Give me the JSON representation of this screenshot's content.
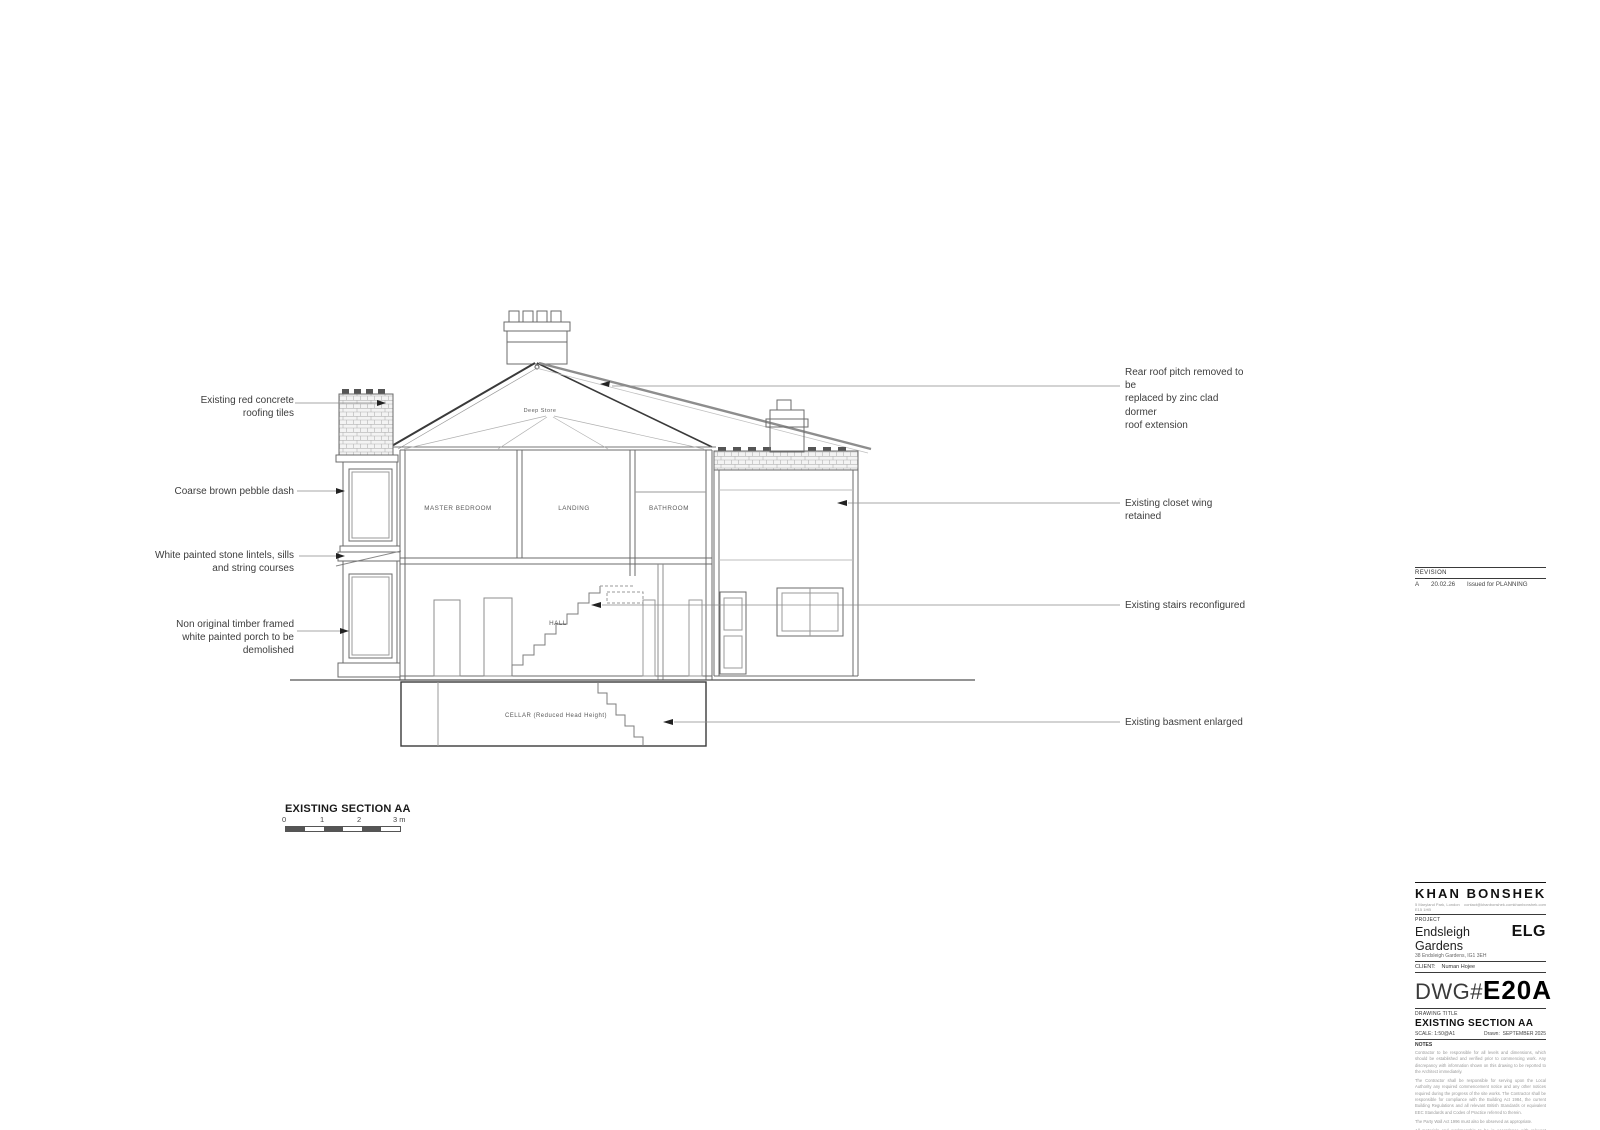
{
  "drawing": {
    "caption": "EXISTING SECTION AA",
    "rooms": {
      "deep_store": "Deep Store",
      "master_bedroom": "MASTER BEDROOM",
      "landing": "LANDING",
      "bathroom": "BATHROOM",
      "hall": "HALL",
      "cellar": "CELLAR (Reduced Head Height)"
    },
    "scale_bar": {
      "ticks": [
        "0",
        "1",
        "2",
        "3 m"
      ]
    }
  },
  "annotations": {
    "left": [
      {
        "label": "Existing red concrete\nroofing tiles"
      },
      {
        "label": "Coarse brown pebble dash"
      },
      {
        "label": "White painted stone lintels, sills\nand string courses"
      },
      {
        "label": "Non original timber framed\nwhite painted porch to be\ndemolished"
      }
    ],
    "right": [
      {
        "label": "Rear roof pitch removed to be\nreplaced by zinc clad dormer\nroof extension"
      },
      {
        "label": "Existing closet wing retained"
      },
      {
        "label": "Existing stairs reconfigured"
      },
      {
        "label": "Existing basment enlarged"
      }
    ]
  },
  "revision": {
    "header": "REVISION",
    "rows": [
      {
        "rev": "A",
        "date": "20.02.26",
        "desc": "Issued for PLANNING"
      }
    ]
  },
  "title_block": {
    "firm_name": "KHAN BONSHEK",
    "firm_address": "5 Maryland Park, London E15 1HB",
    "firm_email": "contact@khanbonshek.com",
    "firm_web": "khanbonshek.com",
    "project_label": "PROJECT",
    "project_name": "Endsleigh Gardens",
    "project_address": "38 Endsleigh Gardens, IG1 3EH",
    "project_code": "ELG",
    "client_label": "CLIENT:",
    "client_name": "Numan Hojee",
    "dwg_label": "DWG#",
    "dwg_number": "E20A",
    "drawing_title_label": "DRAWING TITLE",
    "drawing_title": "EXISTING SECTION AA",
    "scale_label": "SCALE:",
    "scale_value": "1:50@A1",
    "drawn_label": "Drawn:",
    "drawn_value": "SEPTEMBER 2025",
    "notes_label": "NOTES",
    "notes": [
      "Contractor to be responsible for all levels and dimensions, which should be established and verified prior to commencing work. Any discrepancy with information shown on this drawing to be reported to the Architect immediately.",
      "The Contractor shall be responsible for serving upon the Local Authority any required commencement notice and any other notices required during the progress of the site works. The Contractor shall be responsible for compliance with the Building Act 1984, the current Building Regulations and all relevant British Standards or equivalent EEC Standards and Codes of Practice referred to therein.",
      "The Party Wall Act 1996 must also be observed as appropriate.",
      "All materials and workmanship to be in accordance with relevant British Standards & Code of Practice including BS 8000:1989 - Workmanship on Building Sites.",
      "All proprietary products and systems to be used in strict accordance with Manufacturer's instructions."
    ]
  }
}
